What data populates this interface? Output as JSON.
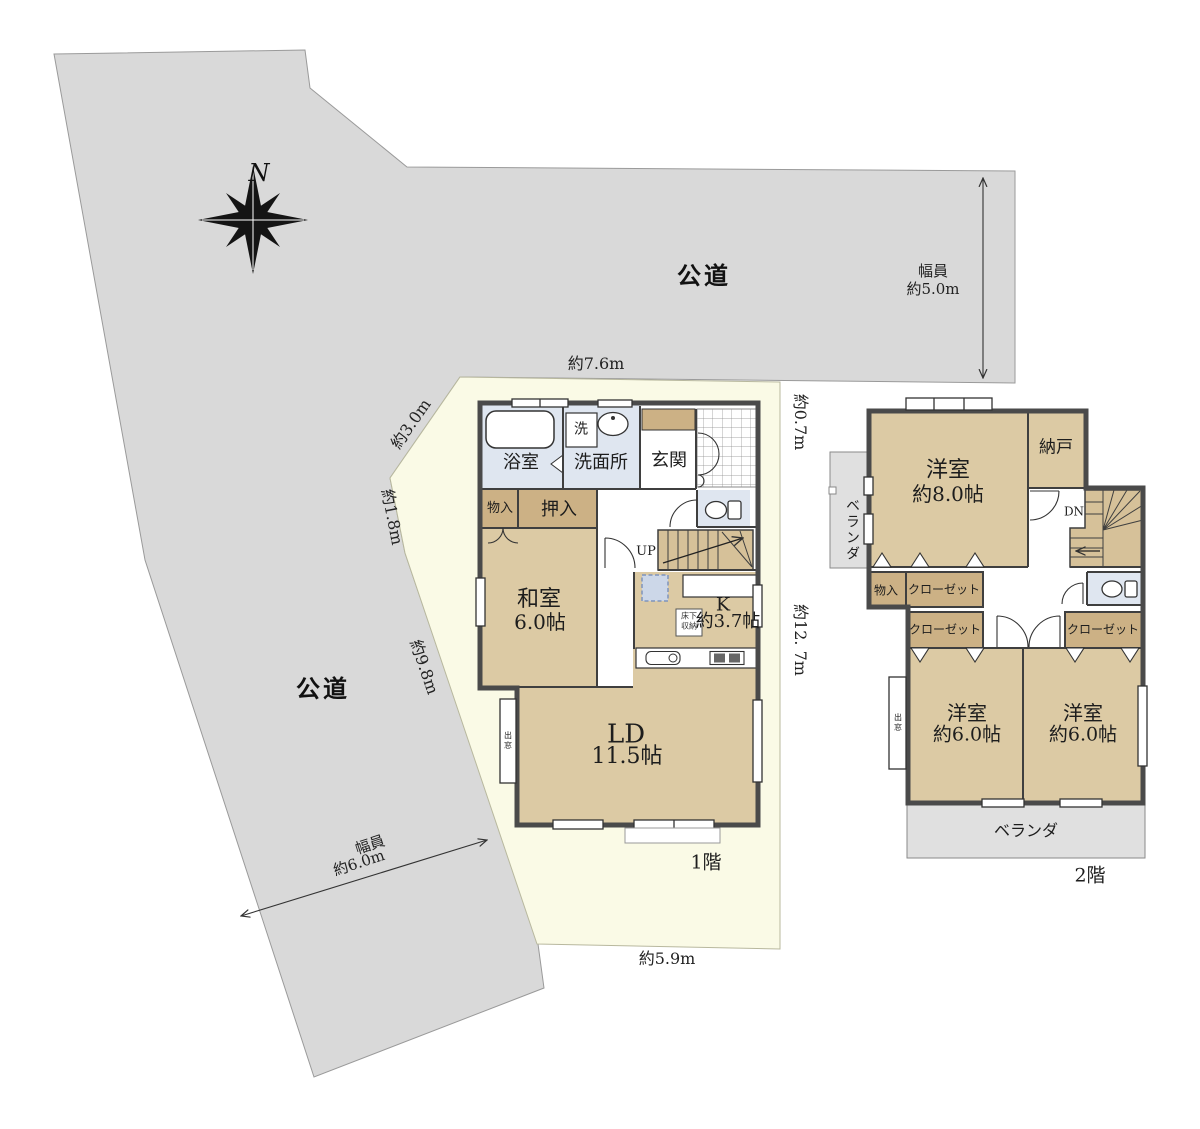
{
  "labels": {
    "north": "N",
    "road_top": "公道",
    "road_left": "公道",
    "width_top_1": "幅員",
    "width_top_2": "約5.0m",
    "width_left_1": "幅員",
    "width_left_2": "約6.0m",
    "dim_top": "約7.6m",
    "dim_slope_upper": "約3.0m",
    "dim_slope_mid": "約1.8m",
    "dim_slope_lower": "約9.8m",
    "dim_right_upper": "約0.7m",
    "dim_right_lower": "約12. 7m",
    "dim_bottom": "約5.9m",
    "floor1": "1階",
    "floor2": "2階"
  },
  "floor1": {
    "bathroom": "浴室",
    "laundry": "洗",
    "washroom": "洗面所",
    "entrance": "玄関",
    "storage": "物入",
    "oshiire": "押入",
    "japanese_room": "和室",
    "japanese_room_size": "6.0帖",
    "stairs_up": "UP",
    "kitchen": "K",
    "kitchen_size": "約3.7帖",
    "underfloor_1": "床下",
    "underfloor_2": "収納",
    "living_dining": "LD",
    "living_dining_size": "11.5帖",
    "bay_window": "出窓"
  },
  "floor2": {
    "bedroom8": "洋室",
    "bedroom8_size": "約8.0帖",
    "storeroom": "納戸",
    "stairs_down": "DN",
    "veranda_side": "ベランダ",
    "storage": "物入",
    "closet_a": "クローゼット",
    "closet_b": "クローゼット",
    "closet_c": "クローゼット",
    "bedroom6_left": "洋室",
    "bedroom6_left_size": "約6.0帖",
    "bedroom6_right": "洋室",
    "bedroom6_right_size": "約6.0帖",
    "veranda_bottom": "ベランダ",
    "bay_window": "出窓"
  },
  "colors": {
    "road": "#d9d9d9",
    "lot": "#fafae6",
    "room": "#dccaa4",
    "closet": "#ccb185",
    "stairs": "#d6c199",
    "wet_area": "#dfe6f0",
    "veranda": "#e0e0e0",
    "wall": "#4a4a4a"
  }
}
